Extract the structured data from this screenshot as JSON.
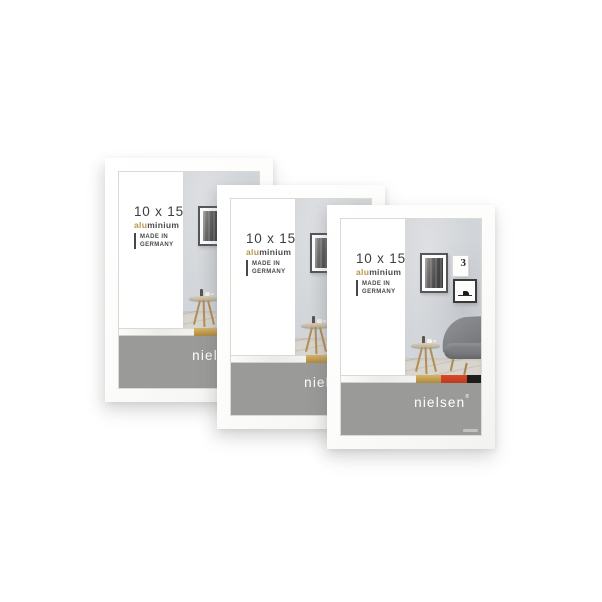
{
  "image_type": "product-photo",
  "product": {
    "brand": "nielsen",
    "brand_mark": "®",
    "size_label": "10 x 15",
    "material_alu": "alu",
    "material_rest": "minium",
    "origin_line1": "MADE IN",
    "origin_line2": "GERMANY",
    "wall_art_number": "3"
  },
  "frames": [
    {
      "name": "frame-back"
    },
    {
      "name": "frame-middle"
    },
    {
      "name": "frame-front"
    }
  ],
  "colors": {
    "page_bg": "#ffffff",
    "frame_white": "#fcfcfb",
    "band_gray": "#9a9a98",
    "text_dark": "#3d3e40",
    "accent_gold": "#b5964a",
    "strip_gold": "#c19a48",
    "strip_red": "#cf4022",
    "strip_black": "#1c1c1a",
    "wall_gray": "#d1d4d8",
    "floor_wood": "#d6d2cc",
    "sofa_gray": "#808285",
    "brand_white": "#ffffff"
  }
}
